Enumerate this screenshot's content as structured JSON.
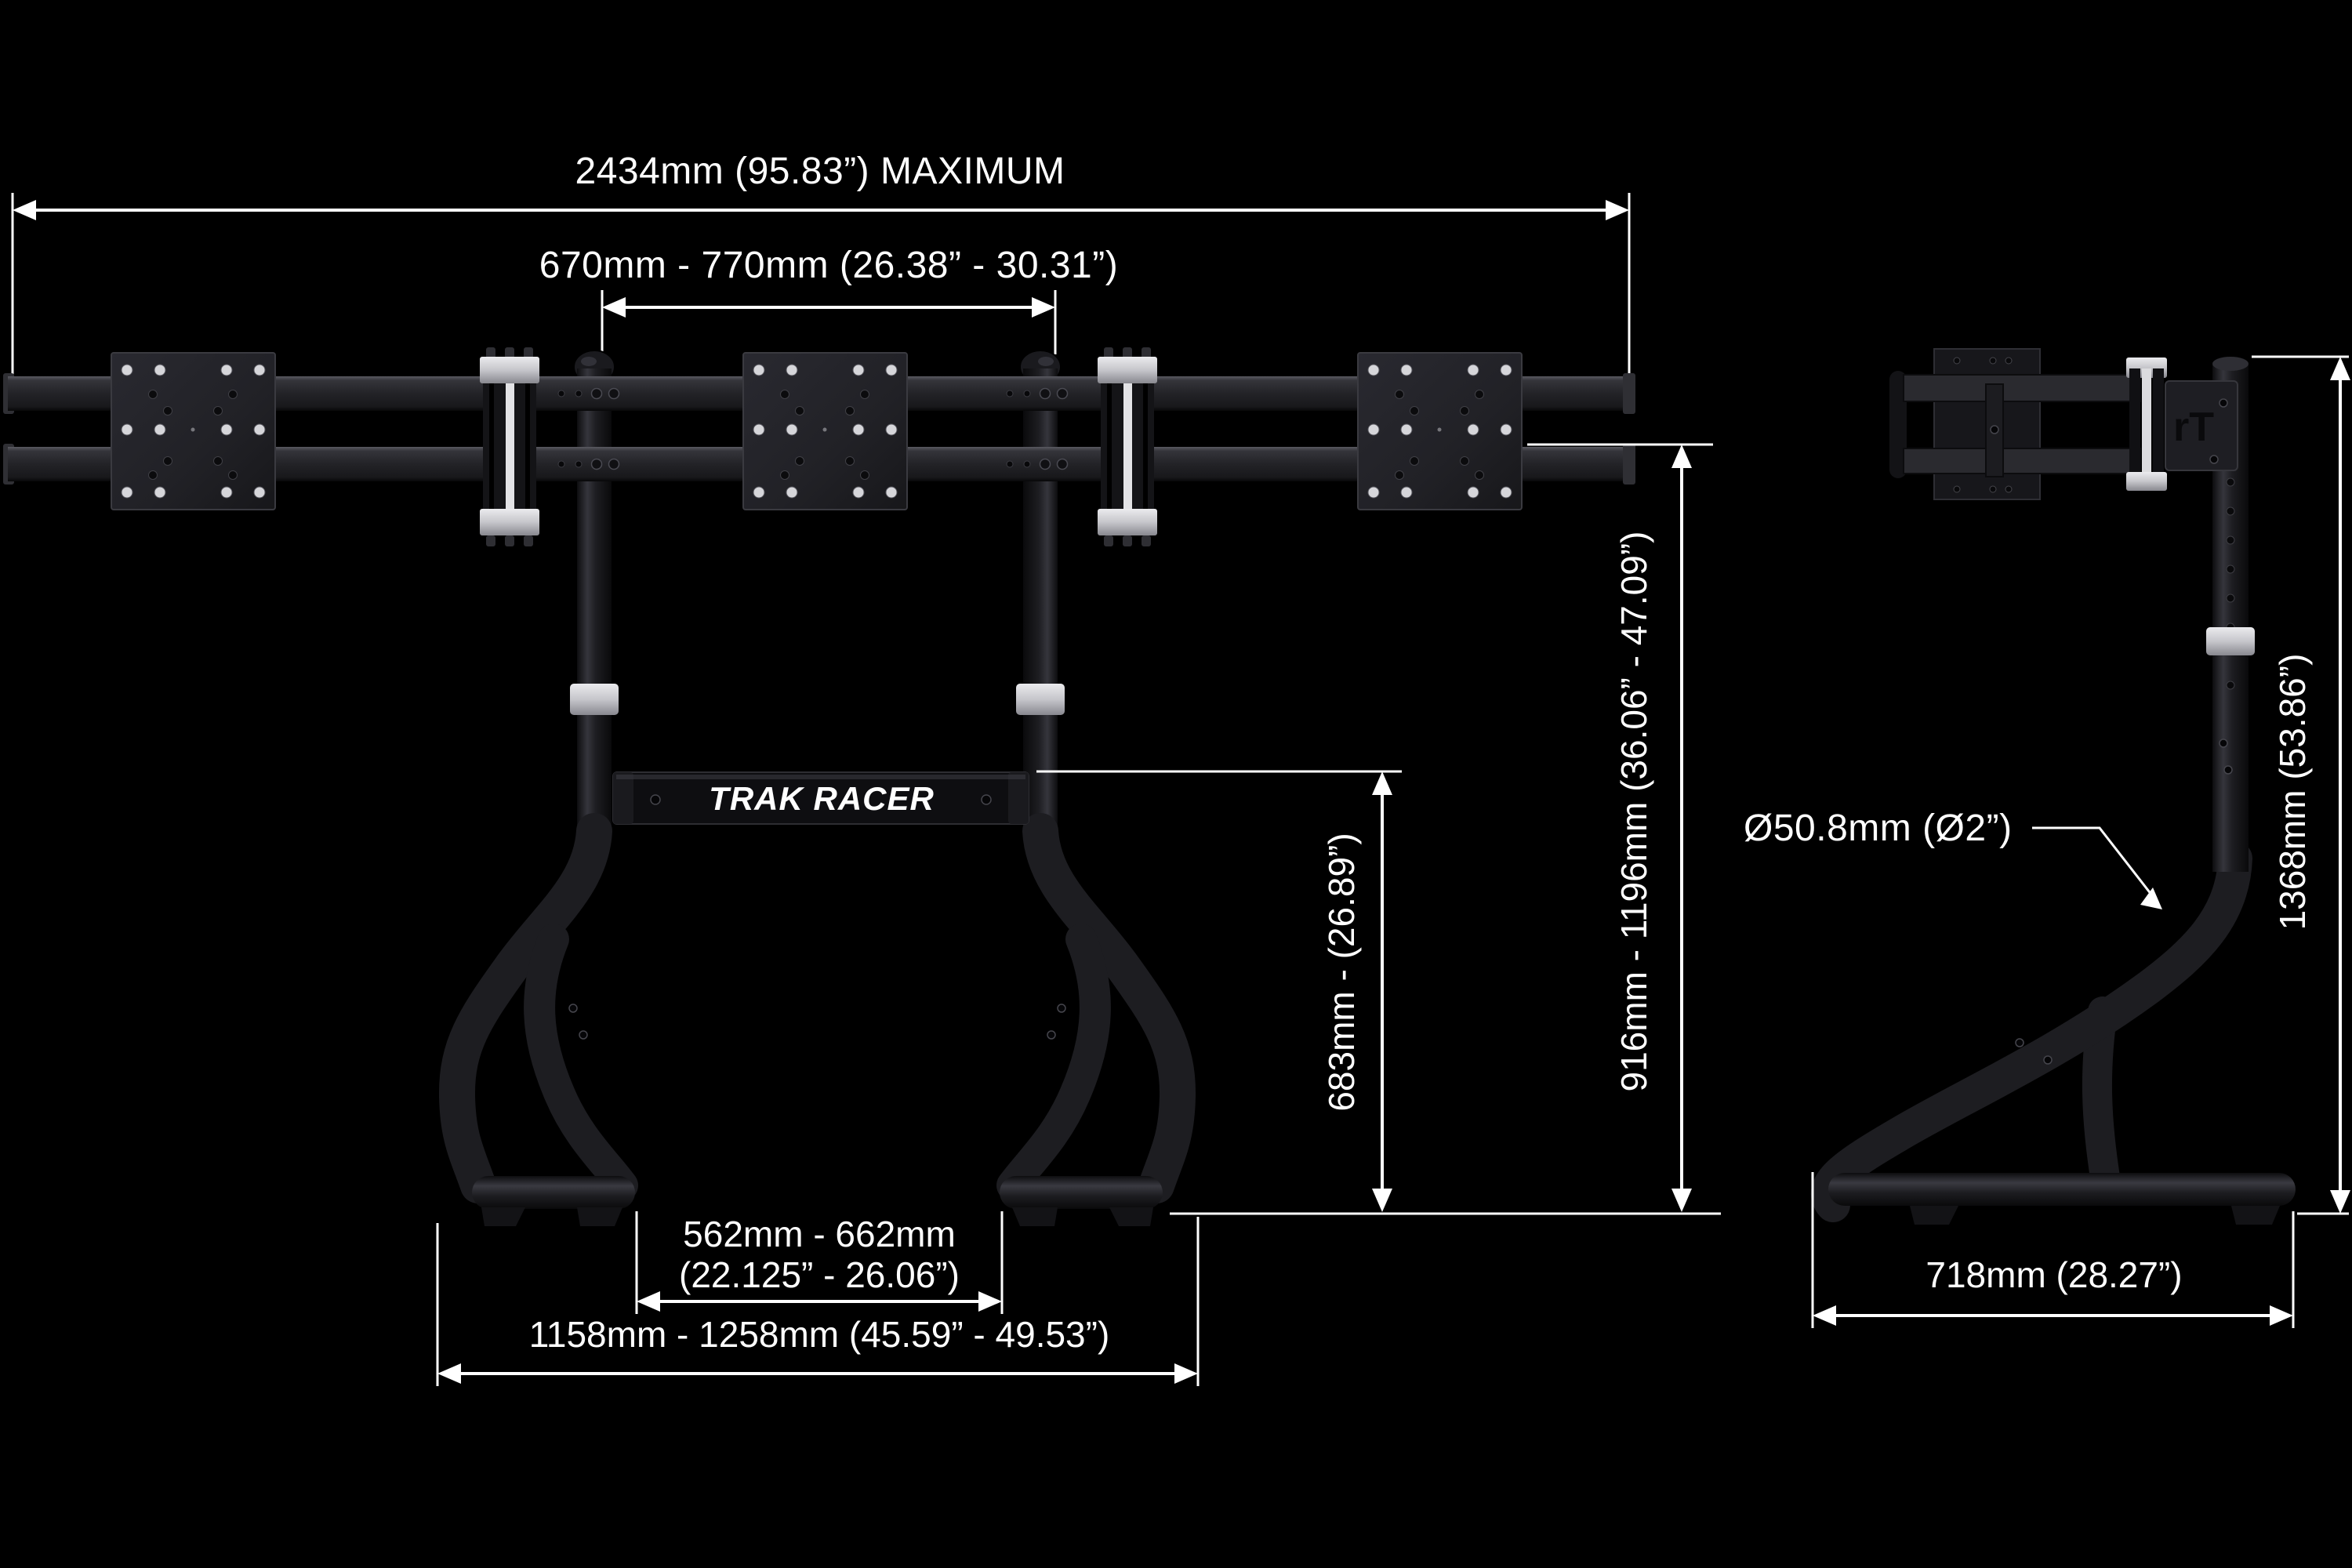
{
  "drawing": {
    "title": "Trak Racer triple monitor stand dimension diagram",
    "brand": {
      "crossbar_logo": "TRAK RACER",
      "side_bracket_monogram": "rT"
    },
    "front_view": {
      "dim_width_max": "2434mm (95.83”) MAXIMUM",
      "dim_mount_spacing": "670mm - 770mm (26.38” - 30.31”)",
      "dim_crossbar_height": "683mm - (26.89”)",
      "dim_rail_height_range": "916mm - 1196mm (36.06” - 47.09”)",
      "dim_feet_inner_line1": "562mm - 662mm",
      "dim_feet_inner_line2": "(22.125” - 26.06”)",
      "dim_feet_outer": "1158mm - 1258mm (45.59” - 49.53”)"
    },
    "side_view": {
      "dim_tube_diameter": "Ø50.8mm (Ø2”)",
      "dim_base_depth": "718mm (28.27”)",
      "dim_total_height": "1368mm (53.86”)"
    },
    "colors": {
      "background": "#000000",
      "dimension_lines": "#ffffff",
      "metal_dark": "#1d1d21",
      "metal_silver": "#c6c6cb"
    }
  }
}
